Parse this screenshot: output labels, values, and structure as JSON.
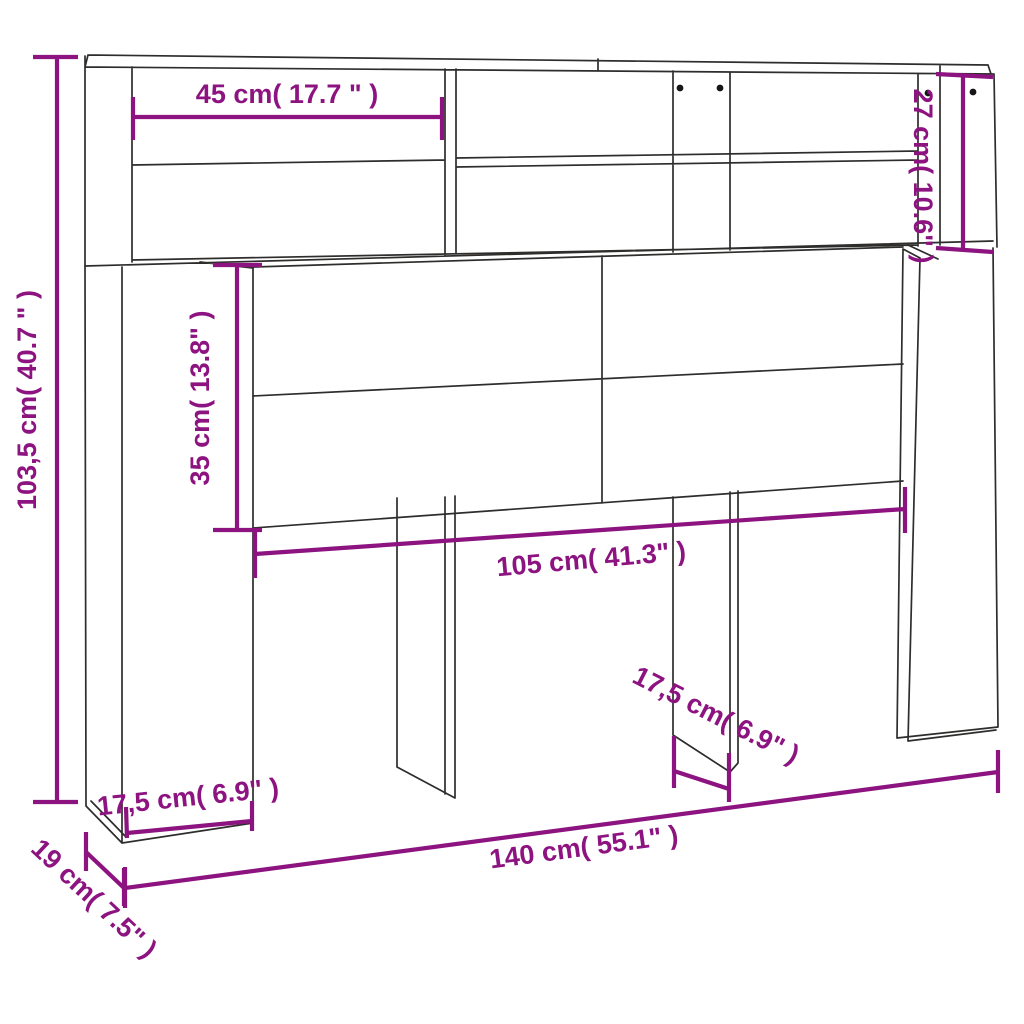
{
  "diagram": {
    "type": "furniture-dimension-diagram",
    "subject": "Headboard cabinet with storage shelves",
    "background": "#ffffff",
    "outline_color": "#2e2d2c",
    "accent_color": "#8c1380",
    "labels": {
      "overall_height": "103,5 cm( 40.7 \" )",
      "top_shelf_width": "45 cm( 17.7 \" )",
      "right_shelf_height": "27 cm( 10.6\" )",
      "mid_panel_height": "35 cm( 13.8\" )",
      "inner_width": "105 cm( 41.3\" )",
      "left_foot_depth": "17,5 cm( 6.9\" )",
      "mid_foot_depth": "17,5 cm( 6.9\" )",
      "overall_width": "140 cm( 55.1\" )",
      "overall_depth": "19 cm( 7.5\" )"
    }
  }
}
